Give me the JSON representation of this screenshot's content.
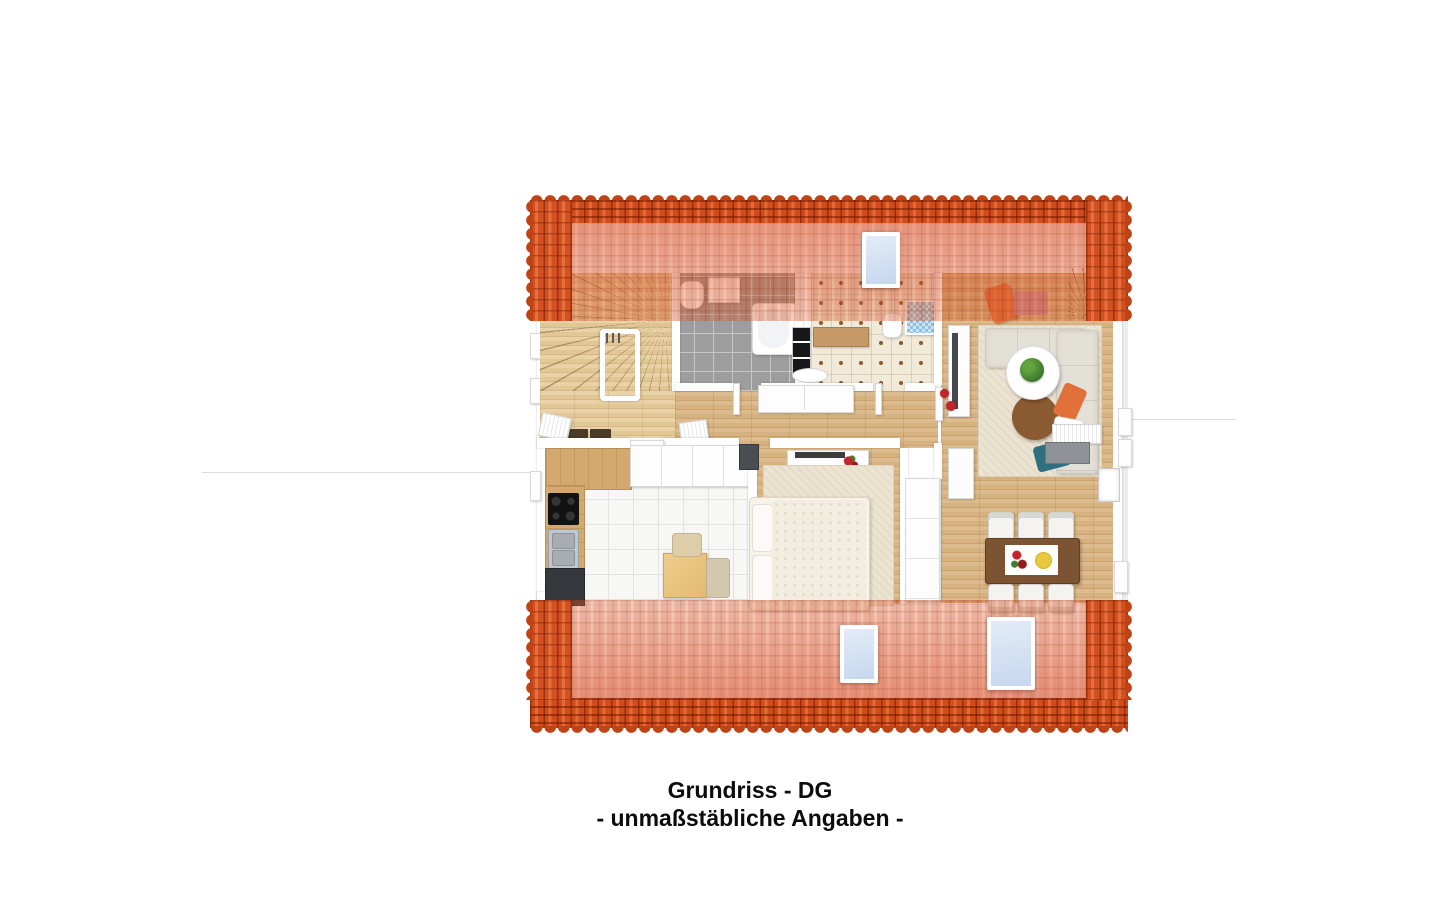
{
  "caption": {
    "line1": "Grundriss - DG",
    "line2": "- unmaßstäbliche Angaben -"
  },
  "colors": {
    "background": "#ffffff",
    "roof_tile": "#d25122",
    "roof_tile_shadow": "#9c3209",
    "roof_tile_highlight": "#e66f3d",
    "roof_overlay_tint": "#d95532",
    "skylight_glass": "#ccdcf0",
    "skylight_frame": "#ffffff",
    "wood_floor": "#d9b98b",
    "wood_floor_dark": "#c9a271",
    "stair_wood": "#e4c89c",
    "gray_tile": "#9d9d9d",
    "white_tile": "#f7f7f6",
    "cream_tile": "#f1ead9",
    "rug_beige": "#ece4d1",
    "sofa_gray": "#e3e0d7",
    "accent_orange": "#e2703a",
    "accent_teal": "#2f6f80",
    "dining_table_brown": "#7c5434",
    "flower_red": "#c2242b",
    "text_black": "#0c0c0c"
  }
}
